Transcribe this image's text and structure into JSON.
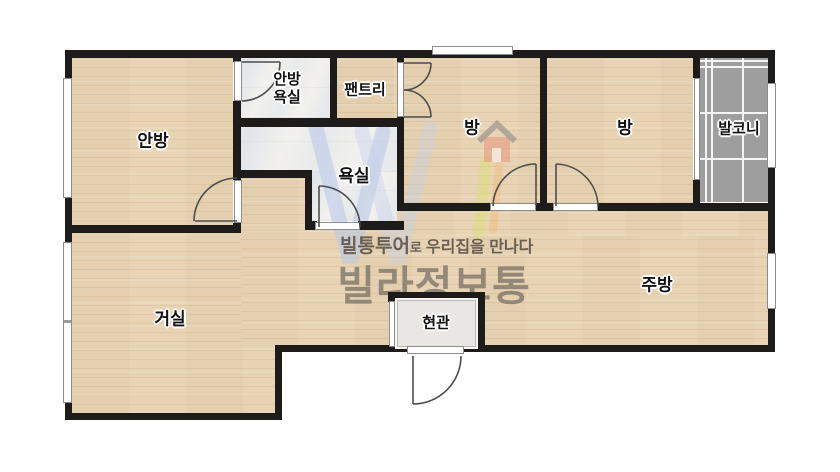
{
  "rooms": {
    "anbang": "안방",
    "anbang_bath": "안방\n욕실",
    "pantry": "팬트리",
    "room_a": "방",
    "room_b": "방",
    "balcony": "발코니",
    "bathroom": "욕실",
    "living": "거실",
    "kitchen": "주방",
    "entrance": "현관"
  },
  "watermark": {
    "tagline_brand": "빌통투어",
    "tagline_particle": "로",
    "tagline_rest": "우리집을 만나다",
    "brand": "빌라정보통"
  },
  "colors": {
    "wall": "#1d1c1a",
    "wood_floor": "#e7d4b4",
    "bath_tile": "#f2f1ee",
    "balcony_tile": "#9e9e9e",
    "entrance_tile": "#e9e7e3",
    "watermark_text": "#7d7568",
    "logo_blue": "#b7c7e8",
    "logo_red": "#e8927c"
  }
}
